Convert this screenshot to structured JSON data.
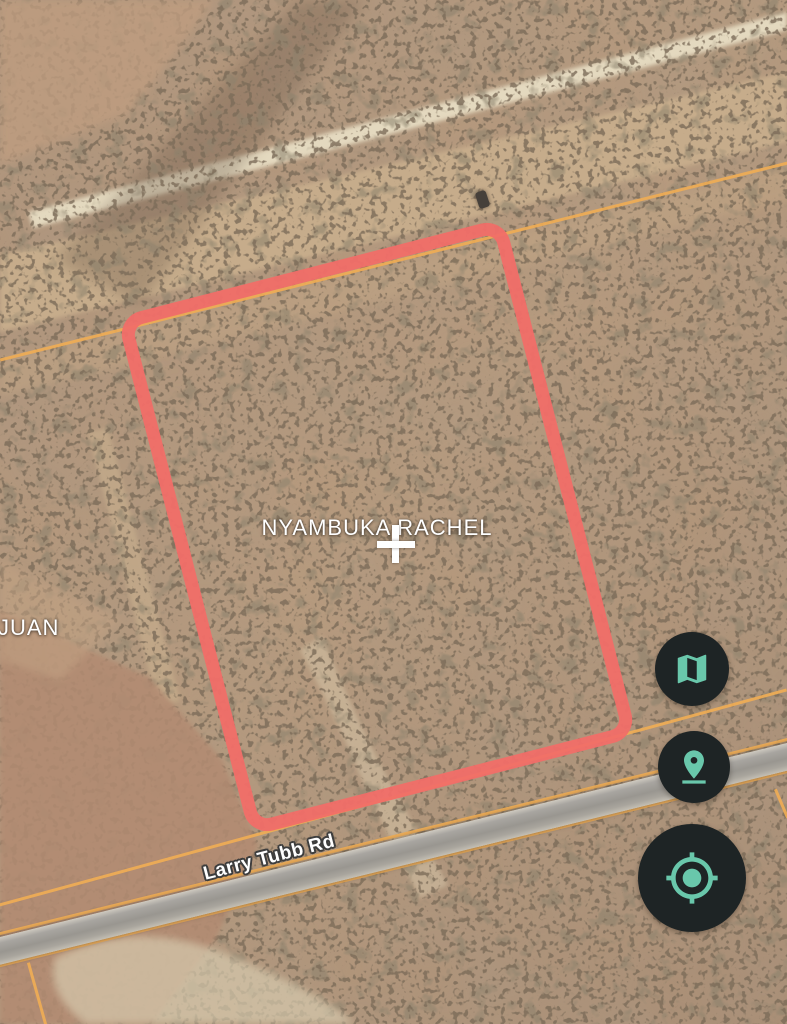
{
  "app": {
    "view": "satellite-parcel-map"
  },
  "parcel": {
    "owner_label": "NYAMBUKA RACHEL",
    "outline_color": "#F16E68"
  },
  "marker": {
    "type": "parcel-center-cross",
    "color": "#FFFFFF"
  },
  "neighbor": {
    "partial_label": "JUAN"
  },
  "road": {
    "name": "Larry Tubb Rd",
    "surface_color": "#9B9791"
  },
  "cadastral": {
    "line_color": "#EFAC55"
  },
  "controls": {
    "bg_color": "#1E2425",
    "icon_color": "#69C7AB",
    "buttons": [
      {
        "id": "map-type-button",
        "icon": "map-icon"
      },
      {
        "id": "parcel-pin-button",
        "icon": "pin-drop-icon"
      },
      {
        "id": "gps-locate-button",
        "icon": "my-location-icon"
      }
    ]
  }
}
